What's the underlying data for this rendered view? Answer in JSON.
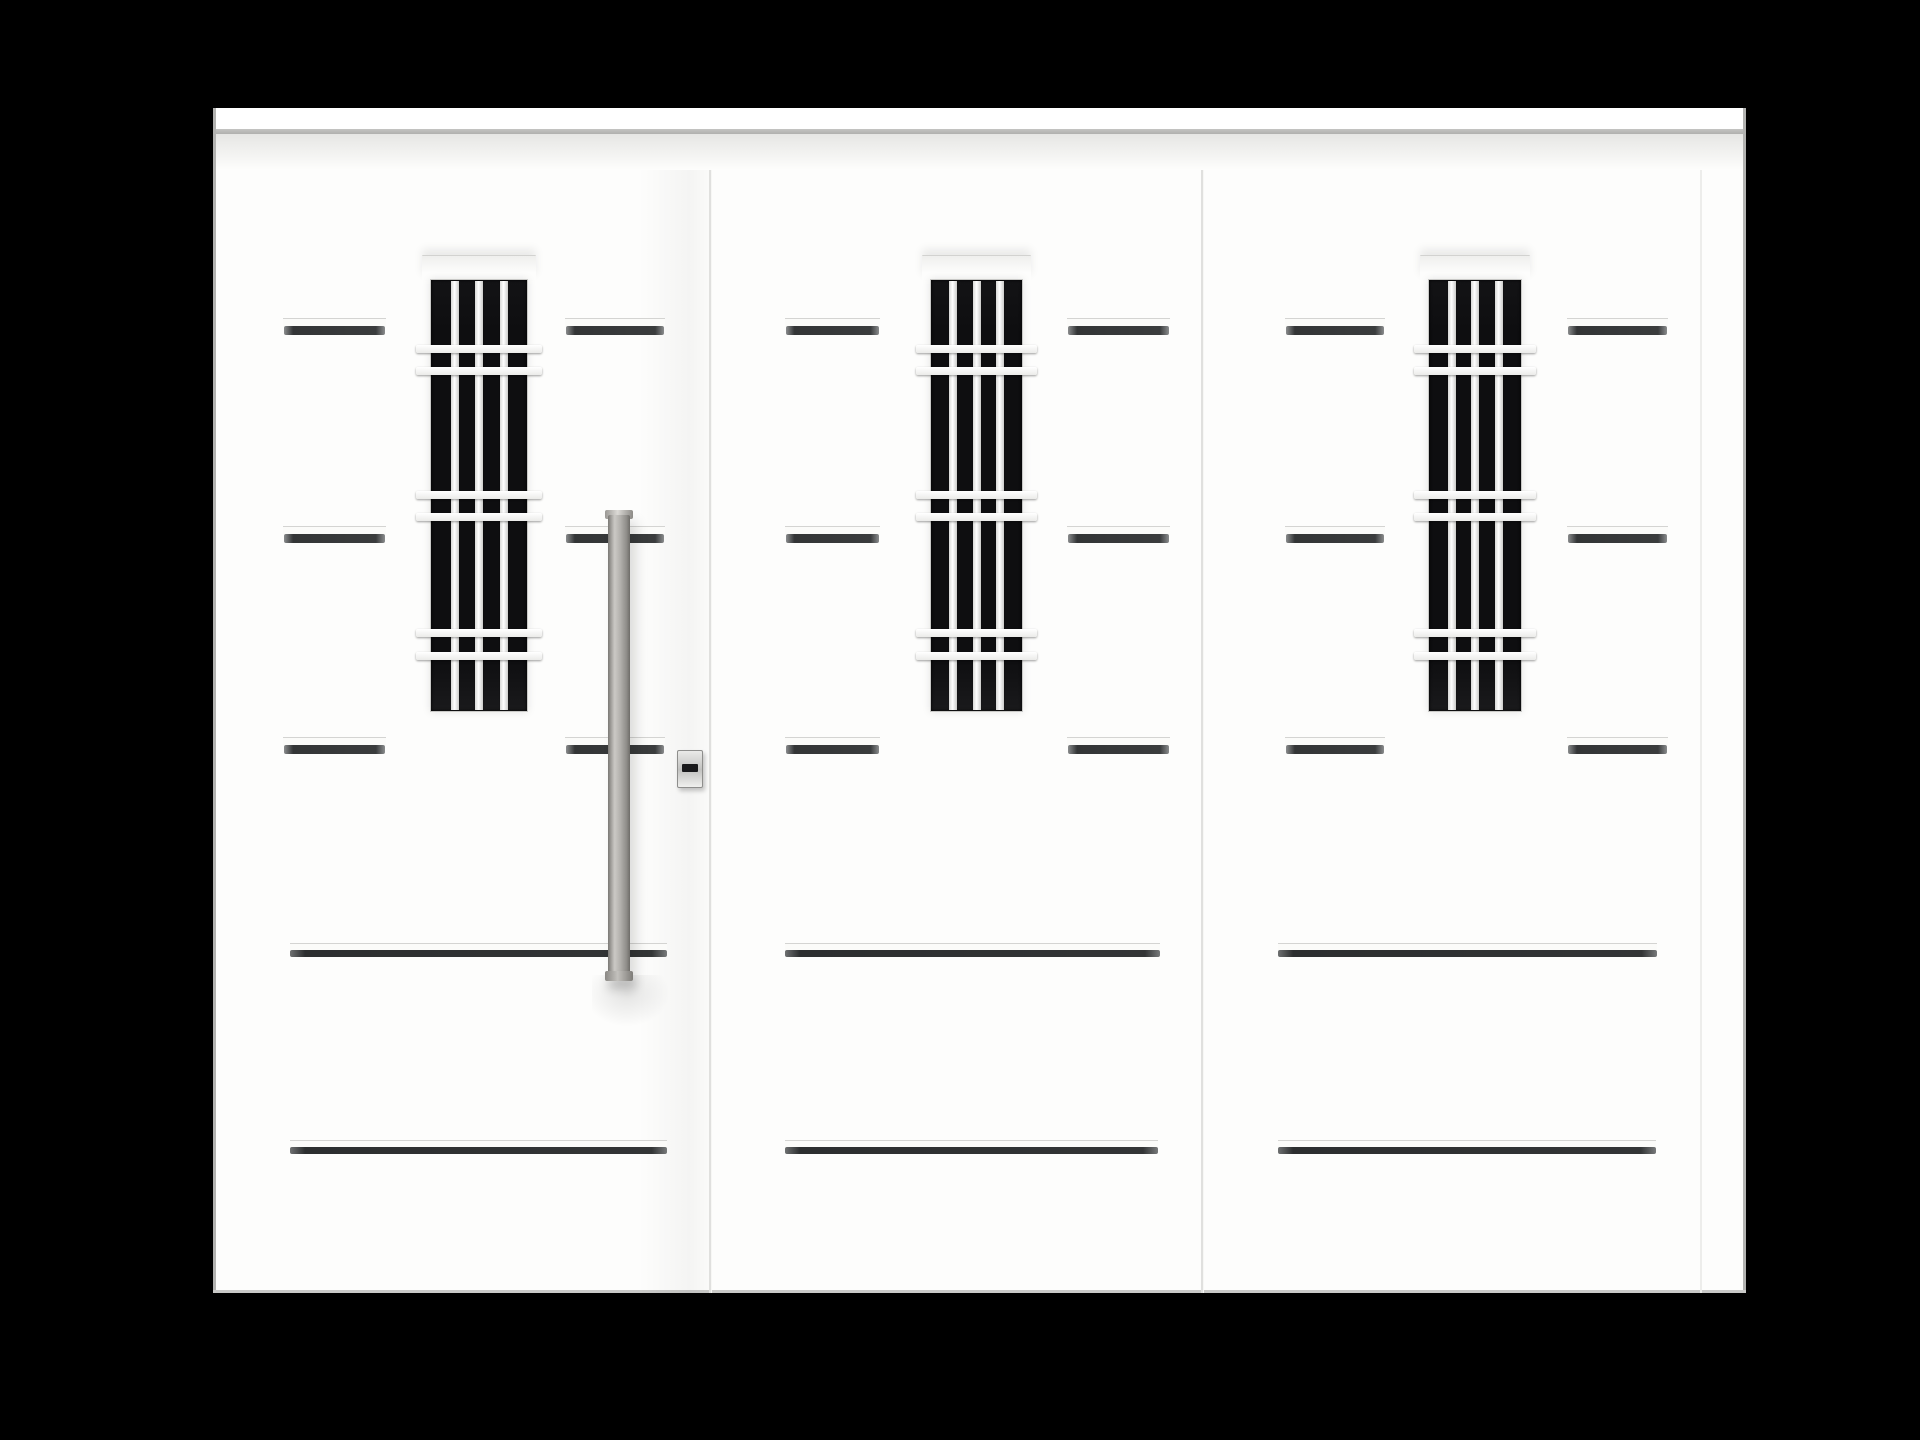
{
  "scene_description": "Product photograph of a white aluminium entry door set: an active door leaf with a long stainless vertical pull handle and cylinder lock plate, plus two matching fixed side panels. Each panel has a tall narrow black glass window with a white security grille (three vertical bars and three pairs of horizontal bars), three rows of short dark trim accents and two long horizontal grooves near the bottom. Black studio background.",
  "canvas": {
    "w": 1920,
    "h": 1440,
    "background": "#000000"
  },
  "door_unit": {
    "x": 213,
    "y": 108,
    "w": 1533,
    "h": 1185
  },
  "cornice": {
    "x": 213,
    "y": 108,
    "w": 1533,
    "top_h": 21,
    "line_h": 5,
    "shade_h": 36
  },
  "panels": [
    {
      "id": "left-door-leaf",
      "label": "door leaf with handle",
      "x": 213,
      "w": 496,
      "window": {
        "glass_x": 430,
        "glass_w": 98
      },
      "accents": [
        {
          "x": 283,
          "w": 103
        },
        {
          "x": 565,
          "w": 100
        }
      ],
      "grooves": [
        {
          "x": 290,
          "w": 377
        },
        {
          "x": 290,
          "w": 377
        }
      ],
      "has_handle": true,
      "has_lock": true,
      "has_leaf_shade": true
    },
    {
      "id": "middle-panel",
      "label": "middle fixed panel",
      "x": 709,
      "w": 492,
      "window": {
        "glass_x": 930,
        "glass_w": 93
      },
      "accents": [
        {
          "x": 785,
          "w": 95
        },
        {
          "x": 1067,
          "w": 103
        }
      ],
      "grooves": [
        {
          "x": 785,
          "w": 375
        },
        {
          "x": 785,
          "w": 373
        }
      ],
      "has_handle": false,
      "has_lock": false,
      "has_leaf_shade": false
    },
    {
      "id": "right-panel",
      "label": "right fixed panel",
      "x": 1201,
      "w": 545,
      "window": {
        "glass_x": 1428,
        "glass_w": 94
      },
      "accents": [
        {
          "x": 1285,
          "w": 100
        },
        {
          "x": 1567,
          "w": 101
        }
      ],
      "grooves": [
        {
          "x": 1278,
          "w": 379
        },
        {
          "x": 1278,
          "w": 378
        }
      ],
      "has_handle": false,
      "has_lock": false,
      "has_leaf_shade": false
    }
  ],
  "window_common": {
    "glass_y": 279,
    "glass_h": 433,
    "lintel_h": 24,
    "lintel_overhang": 8,
    "grille_overhang": 14,
    "bar_h": 8,
    "pair_bar_ys": [
      345,
      367,
      491,
      513,
      629,
      652
    ],
    "muntin_w": 8,
    "muntin_fracs": [
      0.25,
      0.5,
      0.75
    ]
  },
  "accent_rows_y": [
    318,
    526,
    737
  ],
  "accent_ledge_h": 8,
  "accent_dark_h": 9,
  "groove_rows_y": [
    943,
    1140
  ],
  "groove_ledge_h": 7,
  "groove_dark_h": 7,
  "seams": {
    "xs": [
      709,
      1201
    ],
    "stile_x": 1700,
    "y_top": 170,
    "y_bottom": 1293
  },
  "handle": {
    "bar_x": 608,
    "bar_y": 515,
    "bar_w": 22,
    "bar_h": 460,
    "cap_x": 605,
    "cap_w": 28,
    "cap_h": 9,
    "shadow": {
      "x": 592,
      "y": 975,
      "w": 78,
      "h": 52
    }
  },
  "lock": {
    "x": 677,
    "y": 750,
    "w": 26,
    "h": 38,
    "slot": {
      "dx": 5,
      "dy": 14,
      "w": 16,
      "h": 8
    }
  },
  "edges": {
    "side_w": 3,
    "bottom_h": 3,
    "leaf_shade": {
      "x": 638,
      "w": 71
    }
  },
  "colors": {
    "bg": "#000000",
    "door_white": "#fdfdfc",
    "cornice_line": "#c4c4c2",
    "cornice_shade": "#e6e6e4",
    "seam": "#e0e0de",
    "stile": "#ededeb",
    "glass": "#0e0e10",
    "glass_edge": "#c9c9c7",
    "ledge": "#fbfbf9",
    "ledge_edge": "#d4d4d2",
    "accent_dark": "#333536",
    "accent_dark2": "#3a3c3d",
    "groove_dark": "#2c2e2f",
    "groove_dark2": "#333536",
    "edge_border": "#b2b2b0",
    "edge_bottom": "#c9c9c7",
    "lock_mid": "#c2c2c0",
    "lock_border": "#8e8e8c",
    "lock_slot": "#1a1a1c"
  }
}
